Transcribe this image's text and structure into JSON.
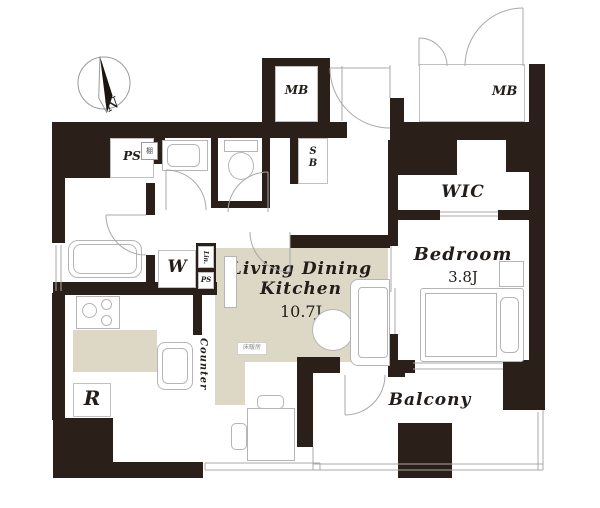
{
  "compass": {
    "label": "N"
  },
  "labels": {
    "ps_box": "PS",
    "shelf": "棚",
    "mb_left": "MB",
    "mb_right": "MB",
    "sb_line1": "S",
    "sb_line2": "B",
    "wic": "WIC",
    "bedroom": "Bedroom",
    "bedroom_size": "3.8J",
    "ldk_line1": "Living Dining",
    "ldk_line2": "Kitchen",
    "ldk_size": "10.7J",
    "floor_heating": "床暖房",
    "counter": "Counter",
    "washer": "W",
    "linen": "Lin.",
    "ps_small": "PS",
    "fridge": "R",
    "balcony": "Balcony"
  },
  "colors": {
    "wall": "#2b1f1a",
    "floor": "#dcd8c5",
    "line": "#b5b5b5",
    "text": "#221d19"
  }
}
